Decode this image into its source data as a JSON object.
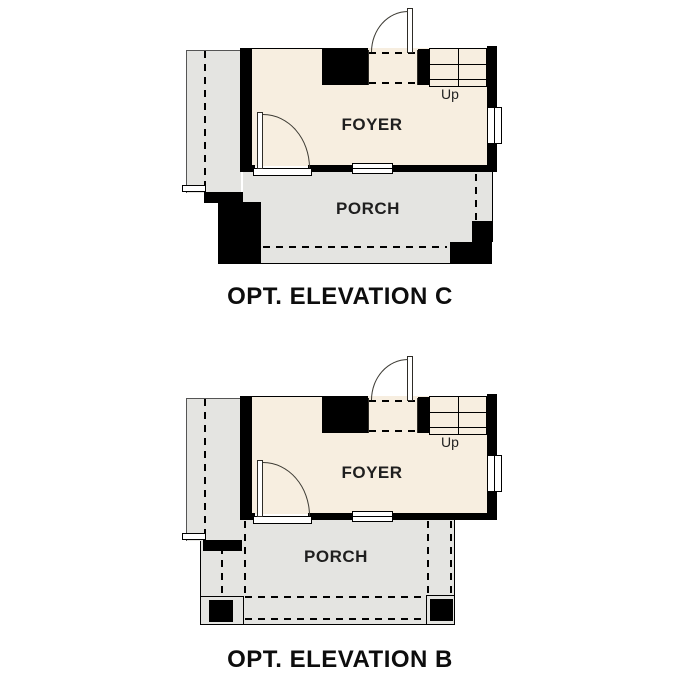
{
  "document": {
    "background": "#ffffff"
  },
  "colors": {
    "wall": "#000000",
    "room_fill": "#f7eee0",
    "porch_fill": "#e4e4e1",
    "line": "#3c3a33",
    "text": "#1f1f1f"
  },
  "plans": [
    {
      "id": "opt-elevation-c",
      "title": "OPT. ELEVATION C",
      "foyer_label": "FOYER",
      "porch_label": "PORCH",
      "stairs_direction_label": "Up"
    },
    {
      "id": "opt-elevation-b",
      "title": "OPT. ELEVATION B",
      "foyer_label": "FOYER",
      "porch_label": "PORCH",
      "stairs_direction_label": "Up"
    }
  ]
}
